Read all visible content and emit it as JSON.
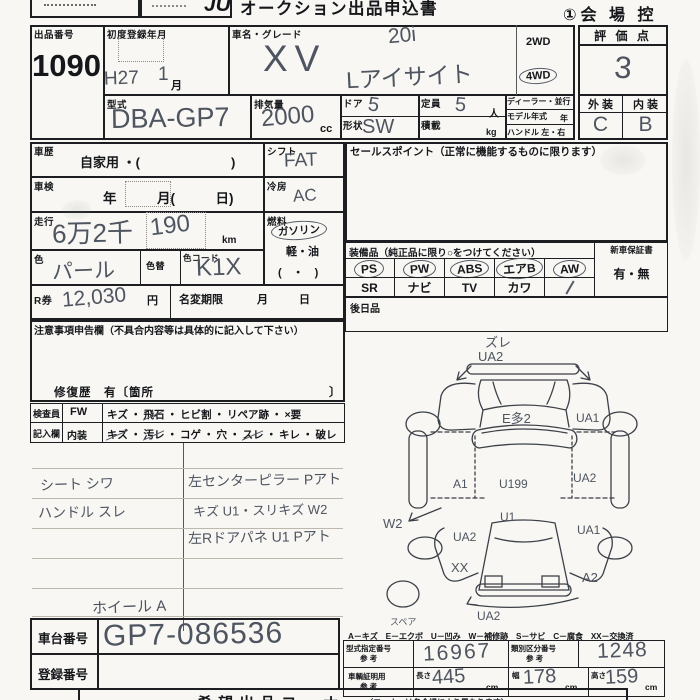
{
  "top": {
    "logo": "JU",
    "title": "オークション出品申込書",
    "copy": "①会 場 控"
  },
  "h1": {
    "lot_label": "出品番号",
    "lot": "1090",
    "reg_label": "初度登録年月",
    "reg_era": "H27",
    "reg_num": "1",
    "reg_month": "月",
    "name_label": "車名・グレード",
    "grade_top": "20i",
    "name": "XV",
    "grade_sub": "Lアイサイト",
    "d2wd": "2WD",
    "d4wd": "4WD",
    "score_label": "評 価 点",
    "score": "3",
    "ext": "外 装",
    "int": "内 装",
    "ext_v": "C",
    "int_v": "B",
    "model_label": "型式",
    "model": "DBA-GP7",
    "disp_label": "排気量",
    "disp": "2000",
    "cc": "cc",
    "door_label": "ドア",
    "door": "5",
    "cap_label": "定員",
    "cap": "5",
    "nin": "人",
    "shape_label": "形状",
    "shape": "SW",
    "load_label": "積載",
    "kg": "kg",
    "dealer": "ディーラー・並行",
    "myear": "モデル年式",
    "year": "年",
    "handle": "ハンドル 左・右"
  },
  "m": {
    "hist_label": "車歴",
    "hist": "自家用 ・(　　　　　　　)",
    "shift_label": "シフト",
    "shift": "FAT",
    "insp_label": "車検",
    "insp": "年　　　月(　　　日)",
    "ac_label": "冷房",
    "ac": "AC",
    "run_label": "走行",
    "run1": "6万2千",
    "run2": "190",
    "km": "km",
    "fuel_label": "燃料",
    "fuel1": "ガソリン",
    "fuel2": "軽・油",
    "fuel3": "(　・　)",
    "color_label": "色",
    "color": "パール",
    "recolor": "色替",
    "ccode_label": "色コード",
    "ccode": "K1X",
    "r_label": "R券",
    "r": "12,030",
    "yen": "円",
    "nv": "名変期限",
    "month": "月",
    "day": "日"
  },
  "notice": {
    "head": "注意事項申告欄（不具合内容等は具体的に記入して下さい）",
    "repair": "修復歴　有〔箇所",
    "close": "〕"
  },
  "insp": {
    "l1": "検査員",
    "l2": "記入欄",
    "fw": "FW",
    "interior": "内装",
    "dot": "・",
    "fw_items": [
      {
        "t": "キズ"
      },
      {
        "t": "飛石",
        "m": true
      },
      {
        "t": "ヒビ割"
      },
      {
        "t": "リペア跡"
      },
      {
        "t": "×要"
      }
    ],
    "in_items": [
      {
        "t": "キズ",
        "m": true
      },
      {
        "t": "汚レ",
        "m": true
      },
      {
        "t": "コゲ"
      },
      {
        "t": "穴"
      },
      {
        "t": "スレ",
        "m": true
      },
      {
        "t": "キレ"
      },
      {
        "t": "破レ"
      }
    ]
  },
  "sales": {
    "head": "セールスポイント（正常に機能するものに限ります）"
  },
  "equip": {
    "head": "装備品（純正品に限り○をつけてください）",
    "warranty": "新車保証書",
    "umu": "有・無",
    "later": "後日品",
    "r1": [
      {
        "t": "PS",
        "c": true
      },
      {
        "t": "PW",
        "c": true
      },
      {
        "t": "ABS",
        "c": true
      },
      {
        "t": "エアB",
        "c": true
      },
      {
        "t": "AW",
        "c": true
      }
    ],
    "r2": [
      {
        "t": "SR"
      },
      {
        "t": "ナビ"
      },
      {
        "t": "TV"
      },
      {
        "t": "カワ"
      },
      {
        "t": "",
        "s": true
      }
    ]
  },
  "notes": {
    "n1": "シート シワ",
    "n2": "ハンドル スレ",
    "n3": "左センターピラー Pアト",
    "n4": "キズ U1・スリキズ W2",
    "n5": "左Rドアパネ U1 Pアト",
    "wheel": "ホイール A"
  },
  "diag": {
    "top": "ズレ",
    "top2": "UA2",
    "hood": "E多2",
    "fr": "UA1",
    "ml": "A1",
    "mc": "U199",
    "mr": "UA2",
    "w2": "W2",
    "rl": "UA2",
    "rw": "U1",
    "rr": "UA1",
    "xx": "XX",
    "a2": "A2",
    "bump": "UA2",
    "spare": "スペア"
  },
  "legend": "A－キズ　E－エクボ　U－凹み　W－補修跡　S－サビ　C－腐食　XX－交換済",
  "bottom": {
    "chassis_label": "車台番号",
    "chassis": "GP7-086536",
    "reg_label": "登録番号",
    "corner": "希望出品コーナー",
    "corner_note": "（コーナーは各会場により異なります）",
    "type_label": "型式指定番号",
    "ref": "参 考",
    "type_no": "16967",
    "class_label": "類別区分番号",
    "class_no": "1248",
    "cert": "車輌証明用",
    "len_label": "長さ",
    "len": "445",
    "wid_label": "幅",
    "wid": "178",
    "hei_label": "高さ",
    "hei": "159",
    "cm": "cm"
  }
}
